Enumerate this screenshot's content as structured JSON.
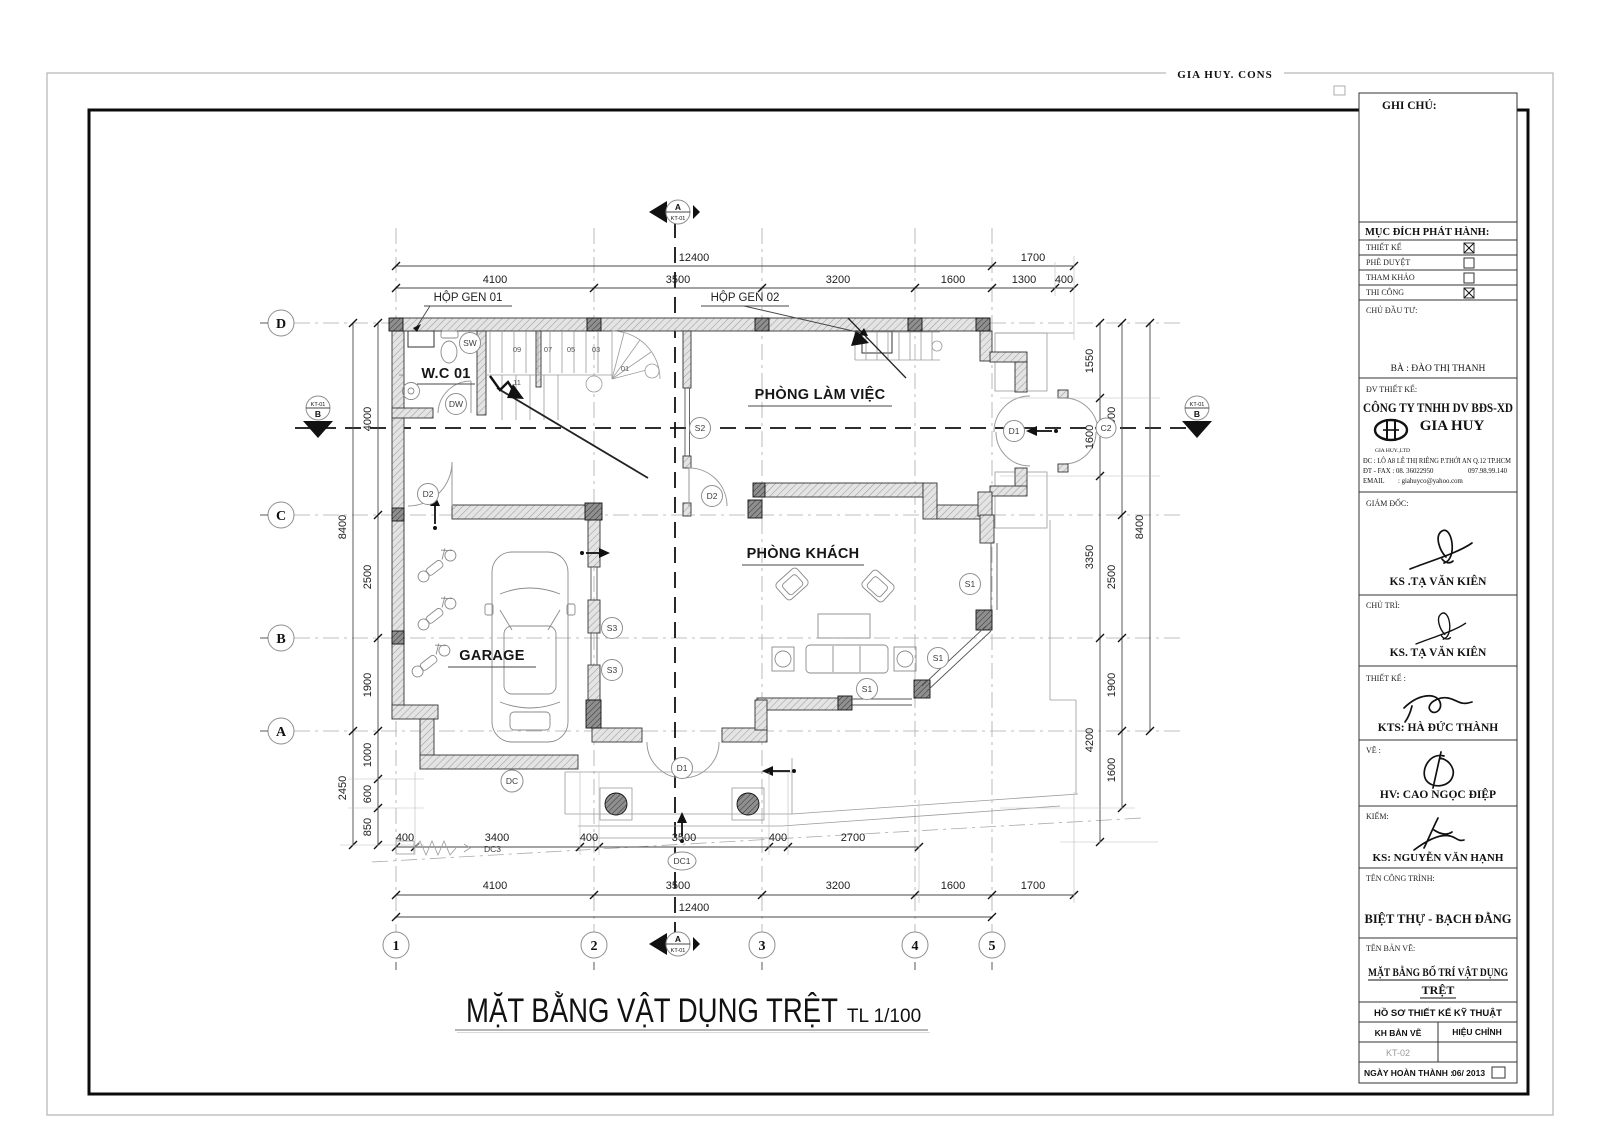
{
  "sheet": {
    "header": "GIA  HUY. CONS",
    "title": "MẶT BẰNG VẬT DỤNG TRỆT",
    "scale_label": "TL 1/100"
  },
  "plan": {
    "rooms": {
      "wc": "W.C 01",
      "office": "PHÒNG LÀM VIỆC",
      "garage": "GARAGE",
      "living": "PHÒNG KHÁCH"
    },
    "tags": {
      "sw": "SW",
      "dw": "DW",
      "s2": "S2",
      "s3": "S3",
      "s1": "S1",
      "d1": "D1",
      "d2": "D2",
      "c2": "C2",
      "dc": "DC",
      "dc1": "DC1",
      "dc3": "DC3",
      "gen1": "HỘP GEN 01",
      "gen2": "HỘP GEN 02"
    },
    "stairs": [
      "09",
      "07",
      "05",
      "03",
      "01",
      "11"
    ],
    "grid": {
      "cols": [
        "1",
        "2",
        "3",
        "4",
        "5"
      ],
      "rows": [
        "D",
        "C",
        "B",
        "A"
      ]
    },
    "section": {
      "a": "A",
      "b": "B",
      "sheet": "KT-01"
    },
    "dims": {
      "top": [
        "12400",
        "1700",
        "4100",
        "3500",
        "3200",
        "1600",
        "1300",
        "400"
      ],
      "bottom": [
        "400",
        "3400",
        "400",
        "3500",
        "400",
        "2700",
        "4100",
        "3500",
        "3200",
        "1600",
        "1700",
        "12400"
      ],
      "left": [
        "8400",
        "2450",
        "4000",
        "2500",
        "1900",
        "1000",
        "600",
        "850"
      ],
      "right": [
        "1550",
        "1600",
        "3350",
        "4200",
        "4000",
        "2500",
        "1900",
        "1600",
        "8400"
      ]
    }
  },
  "titleblock": {
    "ghi_chu": "GHI CHÚ:",
    "muc_dich": "MỤC ĐÍCH PHÁT HÀNH:",
    "release_rows": [
      {
        "label": "THIẾT KẾ",
        "checked": true
      },
      {
        "label": "PHÊ DUYỆT",
        "checked": false
      },
      {
        "label": "THAM KHẢO",
        "checked": false
      },
      {
        "label": "THI CÔNG",
        "checked": true
      }
    ],
    "chu_dau_tu": "CHỦ ĐẦU TƯ:",
    "owner": "BÀ : ĐÀO THỊ THANH",
    "dv_thiet_ke": "ĐV THIẾT KẾ:",
    "company_line1": "CÔNG TY TNHH DV BĐS-XD",
    "company_line2": "GIA HUY",
    "company_sub": "GIA HUY.,LTD",
    "address": "ĐC : LÔ A8 LÊ THỊ RIÊNG P.THỚI AN Q.12 TP.HCM",
    "phone": "ĐT - FAX  :  08. 36022950",
    "phone2": "097.98.99.140",
    "email_label": "EMAIL",
    "email": ":  giahuyco@yahoo.com",
    "signers": [
      {
        "role": "GIÁM ĐỐC:",
        "name": "KS .TẠ VĂN KIÊN"
      },
      {
        "role": "CHỦ TRÌ:",
        "name": "KS. TẠ VĂN KIÊN"
      },
      {
        "role": "THIẾT KẾ  :",
        "name": "KTS: HÀ ĐỨC THÀNH"
      },
      {
        "role": "VẼ :",
        "name": "HV: CAO NGỌC ĐIỆP"
      },
      {
        "role": "KIỂM:",
        "name": "KS: NGUYỄN VĂN HẠNH"
      }
    ],
    "ten_cong_trinh": "TÊN CÔNG TRÌNH:",
    "project": "BIỆT THỰ - BẠCH ĐẰNG",
    "ten_ban_ve": "TÊN BẢN VẼ:",
    "drawing_name_1": "MẶT BẰNG BỐ TRÍ VẬT DỤNG",
    "drawing_name_2": "TRỆT",
    "ho_so": "HỒ SƠ THIẾT KẾ KỸ THUẬT",
    "kh_ban_ve": "KH BẢN VẼ",
    "hieu_chinh": "HIỆU CHỈNH",
    "sheet_no": "KT-02",
    "ngay_label": "NGÀY HOÀN THÀNH :",
    "date": "06/ 2013"
  }
}
